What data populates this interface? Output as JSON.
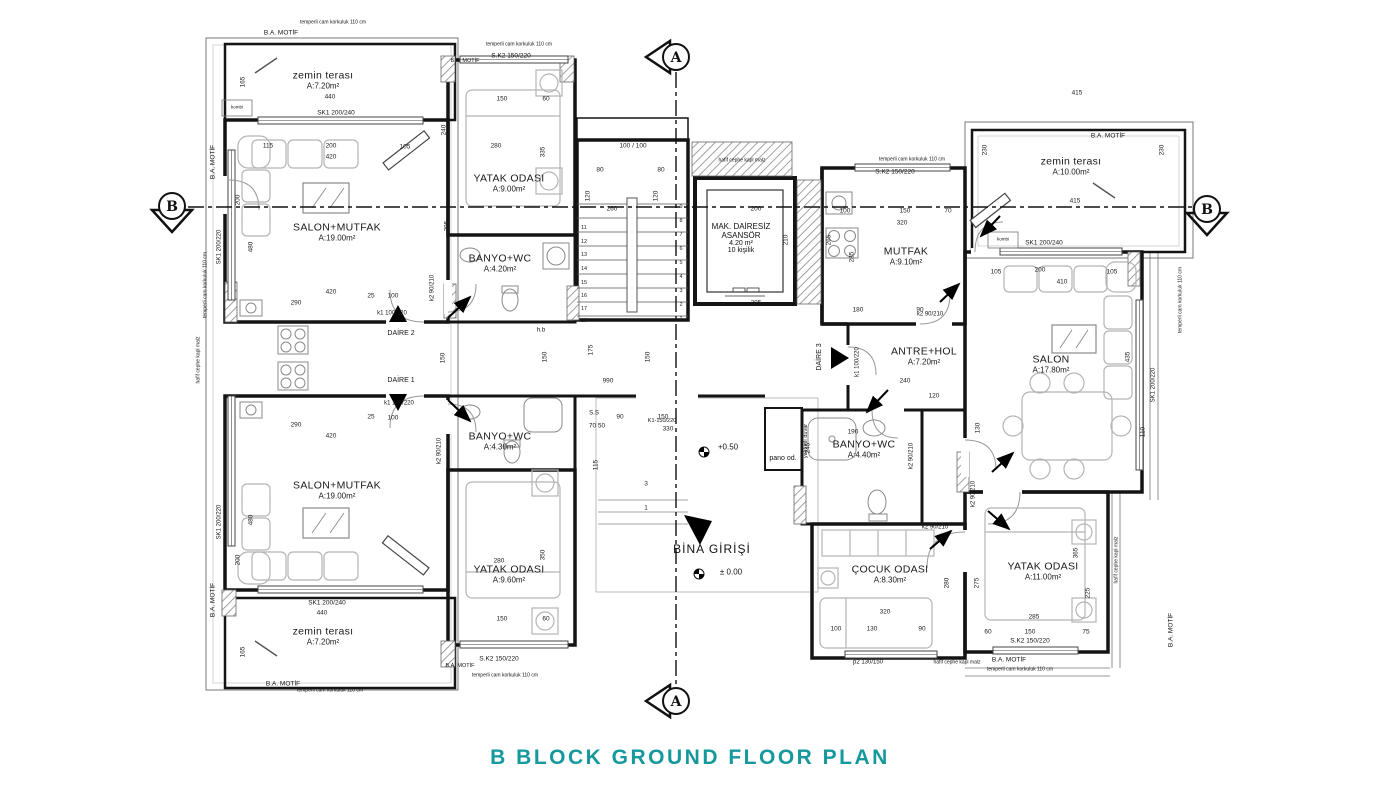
{
  "title": {
    "text": "B BLOCK GROUND FLOOR PLAN",
    "color": "#16999C"
  },
  "section_markers": {
    "top": "A",
    "bottom": "A",
    "left": "B",
    "right": "B"
  },
  "entrance": {
    "label": "BİNA GİRİŞİ"
  },
  "elevator": {
    "l1": "MAK. DAİRESİZ",
    "l2": "ASANSÖR",
    "l3": "4.20 m²",
    "l4": "10 kişilik"
  },
  "rooms": [
    {
      "name": "zemin terası",
      "area": "A:7.20m²",
      "x": 323,
      "y": 80
    },
    {
      "name": "SALON+MUTFAK",
      "area": "A:19.00m²",
      "x": 337,
      "y": 232
    },
    {
      "name": "YATAK ODASI",
      "area": "A:9.00m²",
      "x": 509,
      "y": 183
    },
    {
      "name": "BANYO+WC",
      "area": "A:4.20m²",
      "x": 500,
      "y": 263
    },
    {
      "name": "SALON+MUTFAK",
      "area": "A:19.00m²",
      "x": 337,
      "y": 490
    },
    {
      "name": "BANYO+WC",
      "area": "A:4.30m²",
      "x": 500,
      "y": 441
    },
    {
      "name": "YATAK ODASI",
      "area": "A:9.60m²",
      "x": 509,
      "y": 574
    },
    {
      "name": "zemin terası",
      "area": "A:7.20m²",
      "x": 323,
      "y": 636
    },
    {
      "name": "MUTFAK",
      "area": "A:9.10m²",
      "x": 906,
      "y": 256
    },
    {
      "name": "ANTRE+HOL",
      "area": "A:7.20m²",
      "x": 924,
      "y": 356
    },
    {
      "name": "BANYO+WC",
      "area": "A:4.40m²",
      "x": 864,
      "y": 449
    },
    {
      "name": "ÇOCUK ODASI",
      "area": "A:8.30m²",
      "x": 890,
      "y": 574
    },
    {
      "name": "YATAK ODASI",
      "area": "A:11.00m²",
      "x": 1043,
      "y": 571
    },
    {
      "name": "SALON",
      "area": "A:17.80m²",
      "x": 1051,
      "y": 364
    },
    {
      "name": "zemin terası",
      "area": "A:10.00m²",
      "x": 1071,
      "y": 166
    }
  ],
  "annotations": [
    {
      "t": "SK1 200/240",
      "x": 336,
      "y": 113,
      "s": 6.5
    },
    {
      "t": "B.A. MOTİF",
      "x": 281,
      "y": 33,
      "s": 6.5
    },
    {
      "t": "temperli cam korkuluk 110 cm",
      "x": 333,
      "y": 23,
      "s": 5
    },
    {
      "t": "S.K2 150/220",
      "x": 511,
      "y": 56,
      "s": 6.5
    },
    {
      "t": "B.A. MOTİF",
      "x": 465,
      "y": 61,
      "s": 5.5
    },
    {
      "t": "temperli cam korkuluk 110 cm",
      "x": 519,
      "y": 45,
      "s": 5
    },
    {
      "t": "temperli cam korkuluk 110 cm",
      "x": 912,
      "y": 160,
      "s": 5
    },
    {
      "t": "S.K2 150/220",
      "x": 895,
      "y": 172,
      "s": 6.5
    },
    {
      "t": "hafif cephe kapl malz",
      "x": 742,
      "y": 161,
      "s": 5
    },
    {
      "t": "B.A. MOTİF",
      "x": 1108,
      "y": 136,
      "s": 6.5
    },
    {
      "t": "SK1 200/240",
      "x": 1044,
      "y": 243,
      "s": 6.5
    },
    {
      "t": "kombi",
      "x": 237,
      "y": 108,
      "s": 4.5
    },
    {
      "t": "kombi",
      "x": 1003,
      "y": 240,
      "s": 4.5
    },
    {
      "t": "DAİRE 2",
      "x": 401,
      "y": 334,
      "s": 7
    },
    {
      "t": "DAİRE 1",
      "x": 401,
      "y": 381,
      "s": 7
    },
    {
      "t": "DAİRE 3",
      "x": 820,
      "y": 357,
      "s": 7,
      "r": 90
    },
    {
      "t": "k1 100/220",
      "x": 392,
      "y": 314,
      "s": 6
    },
    {
      "t": "k1 100/220",
      "x": 399,
      "y": 404,
      "s": 6
    },
    {
      "t": "k1 100/220",
      "x": 858,
      "y": 362,
      "s": 6,
      "r": 90
    },
    {
      "t": "k2 90/210",
      "x": 433,
      "y": 288,
      "s": 6,
      "r": 90
    },
    {
      "t": "k2 90/210",
      "x": 440,
      "y": 451,
      "s": 6,
      "r": 90
    },
    {
      "t": "k2 90/210",
      "x": 930,
      "y": 315,
      "s": 6
    },
    {
      "t": "k2 90/210",
      "x": 912,
      "y": 456,
      "s": 6,
      "r": 90
    },
    {
      "t": "k2 90/210",
      "x": 935,
      "y": 528,
      "s": 6
    },
    {
      "t": "k2 90/210",
      "x": 974,
      "y": 494,
      "s": 6,
      "r": 90
    },
    {
      "t": "h.b",
      "x": 541,
      "y": 331,
      "s": 6
    },
    {
      "t": "S.S",
      "x": 594,
      "y": 414,
      "s": 6
    },
    {
      "t": "K1-150/220",
      "x": 662,
      "y": 421,
      "s": 5.5
    },
    {
      "t": "pano od.",
      "x": 783,
      "y": 459,
      "s": 7
    },
    {
      "t": "yalıtımlı duvar",
      "x": 806,
      "y": 441,
      "s": 5.5,
      "r": 90
    },
    {
      "t": "p2 130/150",
      "x": 868,
      "y": 663,
      "s": 6
    },
    {
      "t": "B.A. MOTİF",
      "x": 1009,
      "y": 660,
      "s": 6.5
    },
    {
      "t": "S.K2 150/220",
      "x": 1030,
      "y": 641,
      "s": 6.5
    },
    {
      "t": "temperli cam korkuluk 110 cm",
      "x": 1020,
      "y": 670,
      "s": 5
    },
    {
      "t": "hafif cephe kapl malz",
      "x": 957,
      "y": 663,
      "s": 5
    },
    {
      "t": "B.A. MOTİF",
      "x": 1171,
      "y": 630,
      "s": 6.5,
      "r": 90
    },
    {
      "t": "SK1 200/220",
      "x": 1154,
      "y": 385,
      "s": 6,
      "r": 90
    },
    {
      "t": "temperli cam korkuluk 110 cm",
      "x": 1181,
      "y": 300,
      "s": 5,
      "r": 90
    },
    {
      "t": "hafif cephe kapl malz",
      "x": 1117,
      "y": 560,
      "s": 5,
      "r": 90
    },
    {
      "t": "B.A. MOTİF",
      "x": 213,
      "y": 162,
      "s": 6.5,
      "r": 90
    },
    {
      "t": "SK1 200/220",
      "x": 220,
      "y": 247,
      "s": 6,
      "r": 90
    },
    {
      "t": "temperli cam korkuluk 110 cm",
      "x": 206,
      "y": 285,
      "s": 5,
      "r": 90
    },
    {
      "t": "SK1 200/220",
      "x": 220,
      "y": 522,
      "s": 6,
      "r": 90
    },
    {
      "t": "B.A. MOTİF",
      "x": 213,
      "y": 600,
      "s": 6.5,
      "r": 90
    },
    {
      "t": "hafif cephe kapl malz",
      "x": 199,
      "y": 360,
      "s": 5,
      "r": 90
    },
    {
      "t": "B.A. MOTİF",
      "x": 283,
      "y": 684,
      "s": 6.5
    },
    {
      "t": "temperli cam korkuluk 110 cm",
      "x": 330,
      "y": 691,
      "s": 5
    },
    {
      "t": "SK1 200/240",
      "x": 327,
      "y": 603,
      "s": 6.5
    },
    {
      "t": "S.K2 150/220",
      "x": 499,
      "y": 659,
      "s": 6.5
    },
    {
      "t": "B.A. MOTİF",
      "x": 460,
      "y": 666,
      "s": 5.5
    },
    {
      "t": "temperli cam korkuluk 110 cm",
      "x": 505,
      "y": 676,
      "s": 5
    },
    {
      "t": "+0.50",
      "x": 728,
      "y": 448,
      "s": 8
    },
    {
      "t": "± 0.00",
      "x": 731,
      "y": 573,
      "s": 8
    }
  ],
  "dimensions": [
    {
      "t": "440",
      "x": 330,
      "y": 97
    },
    {
      "t": "165",
      "x": 243,
      "y": 82,
      "r": 90
    },
    {
      "t": "115",
      "x": 268,
      "y": 146
    },
    {
      "t": "200",
      "x": 331,
      "y": 146
    },
    {
      "t": "420",
      "x": 331,
      "y": 157
    },
    {
      "t": "105",
      "x": 405,
      "y": 147
    },
    {
      "t": "240",
      "x": 444,
      "y": 130,
      "r": 90
    },
    {
      "t": "150",
      "x": 502,
      "y": 99
    },
    {
      "t": "60",
      "x": 546,
      "y": 99
    },
    {
      "t": "280",
      "x": 496,
      "y": 146
    },
    {
      "t": "335",
      "x": 543,
      "y": 152,
      "r": 90
    },
    {
      "t": "290",
      "x": 296,
      "y": 303
    },
    {
      "t": "420",
      "x": 331,
      "y": 292
    },
    {
      "t": "480",
      "x": 251,
      "y": 247,
      "r": 90
    },
    {
      "t": "200",
      "x": 238,
      "y": 200,
      "r": 90
    },
    {
      "t": "395",
      "x": 447,
      "y": 226,
      "r": 90
    },
    {
      "t": "25",
      "x": 371,
      "y": 296
    },
    {
      "t": "100",
      "x": 393,
      "y": 296
    },
    {
      "t": "25",
      "x": 371,
      "y": 417
    },
    {
      "t": "100",
      "x": 393,
      "y": 418
    },
    {
      "t": "150",
      "x": 443,
      "y": 358,
      "r": 90
    },
    {
      "t": "150",
      "x": 545,
      "y": 357,
      "r": 90
    },
    {
      "t": "150",
      "x": 648,
      "y": 357,
      "r": 90
    },
    {
      "t": "175",
      "x": 591,
      "y": 350,
      "r": 90
    },
    {
      "t": "990",
      "x": 608,
      "y": 381
    },
    {
      "t": "100 / 100",
      "x": 633,
      "y": 146
    },
    {
      "t": "80",
      "x": 600,
      "y": 170
    },
    {
      "t": "80",
      "x": 661,
      "y": 170
    },
    {
      "t": "120",
      "x": 588,
      "y": 196,
      "r": 90
    },
    {
      "t": "120",
      "x": 656,
      "y": 196,
      "r": 90
    },
    {
      "t": "260",
      "x": 612,
      "y": 209
    },
    {
      "t": "200",
      "x": 756,
      "y": 209
    },
    {
      "t": "210",
      "x": 786,
      "y": 240,
      "r": 90
    },
    {
      "t": "205",
      "x": 756,
      "y": 303
    },
    {
      "t": "100",
      "x": 845,
      "y": 211
    },
    {
      "t": "150",
      "x": 905,
      "y": 211
    },
    {
      "t": "70",
      "x": 948,
      "y": 211
    },
    {
      "t": "320",
      "x": 902,
      "y": 223
    },
    {
      "t": "285",
      "x": 852,
      "y": 257,
      "r": 90
    },
    {
      "t": "265",
      "x": 829,
      "y": 240,
      "r": 90
    },
    {
      "t": "180",
      "x": 858,
      "y": 310
    },
    {
      "t": "90",
      "x": 920,
      "y": 310
    },
    {
      "t": "415",
      "x": 1077,
      "y": 93
    },
    {
      "t": "230",
      "x": 985,
      "y": 150,
      "r": 90
    },
    {
      "t": "230",
      "x": 1162,
      "y": 150,
      "r": 90
    },
    {
      "t": "415",
      "x": 1075,
      "y": 201
    },
    {
      "t": "105",
      "x": 996,
      "y": 272
    },
    {
      "t": "200",
      "x": 1040,
      "y": 270
    },
    {
      "t": "105",
      "x": 1112,
      "y": 272
    },
    {
      "t": "410",
      "x": 1062,
      "y": 282
    },
    {
      "t": "435",
      "x": 1128,
      "y": 357,
      "r": 90
    },
    {
      "t": "110",
      "x": 1143,
      "y": 432,
      "r": 90
    },
    {
      "t": "240",
      "x": 905,
      "y": 381
    },
    {
      "t": "120",
      "x": 934,
      "y": 396
    },
    {
      "t": "130",
      "x": 978,
      "y": 428,
      "r": 90
    },
    {
      "t": "190",
      "x": 853,
      "y": 432
    },
    {
      "t": "245",
      "x": 808,
      "y": 448,
      "r": 90
    },
    {
      "t": "320",
      "x": 885,
      "y": 612
    },
    {
      "t": "100",
      "x": 836,
      "y": 629
    },
    {
      "t": "130",
      "x": 872,
      "y": 629
    },
    {
      "t": "90",
      "x": 922,
      "y": 629
    },
    {
      "t": "280",
      "x": 947,
      "y": 583,
      "r": 90
    },
    {
      "t": "275",
      "x": 977,
      "y": 583,
      "r": 90
    },
    {
      "t": "285",
      "x": 1034,
      "y": 617
    },
    {
      "t": "150",
      "x": 1030,
      "y": 632
    },
    {
      "t": "60",
      "x": 988,
      "y": 632
    },
    {
      "t": "75",
      "x": 1086,
      "y": 632
    },
    {
      "t": "225",
      "x": 1088,
      "y": 593,
      "r": 90
    },
    {
      "t": "365",
      "x": 1076,
      "y": 553,
      "r": 90
    },
    {
      "t": "440",
      "x": 322,
      "y": 613
    },
    {
      "t": "165",
      "x": 243,
      "y": 652,
      "r": 90
    },
    {
      "t": "150",
      "x": 502,
      "y": 619
    },
    {
      "t": "60",
      "x": 546,
      "y": 619
    },
    {
      "t": "280",
      "x": 499,
      "y": 561
    },
    {
      "t": "350",
      "x": 543,
      "y": 555,
      "r": 90
    },
    {
      "t": "290",
      "x": 296,
      "y": 425
    },
    {
      "t": "420",
      "x": 331,
      "y": 436
    },
    {
      "t": "480",
      "x": 251,
      "y": 520,
      "r": 90
    },
    {
      "t": "200",
      "x": 238,
      "y": 560,
      "r": 90
    },
    {
      "t": "90",
      "x": 620,
      "y": 417
    },
    {
      "t": "150",
      "x": 663,
      "y": 417
    },
    {
      "t": "330",
      "x": 668,
      "y": 429
    },
    {
      "t": "115",
      "x": 596,
      "y": 465,
      "r": 90
    },
    {
      "t": "70 50",
      "x": 597,
      "y": 426
    },
    {
      "t": "3",
      "x": 646,
      "y": 484
    },
    {
      "t": "1",
      "x": 646,
      "y": 508
    }
  ],
  "stair_numbers": [
    {
      "t": "11",
      "x": 584,
      "y": 228
    },
    {
      "t": "12",
      "x": 584,
      "y": 242
    },
    {
      "t": "13",
      "x": 584,
      "y": 255
    },
    {
      "t": "14",
      "x": 584,
      "y": 269
    },
    {
      "t": "15",
      "x": 584,
      "y": 283
    },
    {
      "t": "16",
      "x": 584,
      "y": 296
    },
    {
      "t": "17",
      "x": 584,
      "y": 309
    },
    {
      "t": "18",
      "x": 584,
      "y": 321
    },
    {
      "t": "9",
      "x": 681,
      "y": 207
    },
    {
      "t": "8",
      "x": 681,
      "y": 221
    },
    {
      "t": "7",
      "x": 681,
      "y": 235
    },
    {
      "t": "6",
      "x": 681,
      "y": 249
    },
    {
      "t": "5",
      "x": 681,
      "y": 263
    },
    {
      "t": "4",
      "x": 681,
      "y": 277
    },
    {
      "t": "3",
      "x": 681,
      "y": 291
    },
    {
      "t": "2",
      "x": 681,
      "y": 305
    },
    {
      "t": "1",
      "x": 681,
      "y": 319
    }
  ]
}
